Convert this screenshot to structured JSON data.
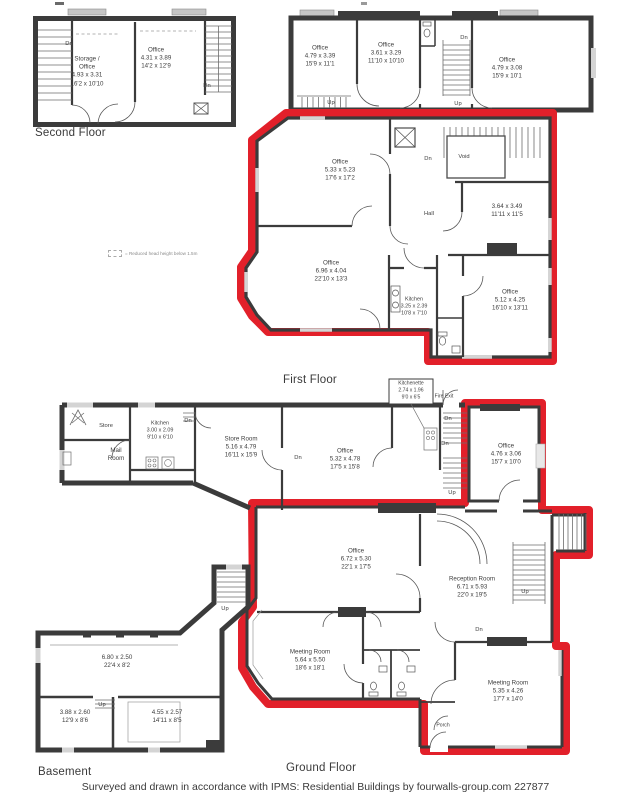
{
  "footer": "Surveyed and drawn in accordance with IPMS: Residential Buildings by fourwalls-group.com 227877",
  "legend": {
    "note": "= Reduced head height below 1.5m"
  },
  "floor_titles": {
    "second": "Second Floor",
    "first": "First Floor",
    "ground": "Ground Floor",
    "basement": "Basement"
  },
  "markers": {
    "dn": "Dn",
    "up": "Up",
    "fire_exit": "Fire Exit",
    "void": "Void",
    "hall": "Hall",
    "porch": "Porch",
    "store": "Store"
  },
  "colors": {
    "highlight_red": "#e2202a",
    "wall": "#3b3b3b"
  },
  "rooms": {
    "sf_storage_office": {
      "name1": "Storage /",
      "name2": "Office",
      "metric": "4.93 x 3.31",
      "imperial": "16'2 x 10'10"
    },
    "sf_office": {
      "name": "Office",
      "metric": "4.31 x 3.89",
      "imperial": "14'2 x 12'9"
    },
    "ff_office_a": {
      "name": "Office",
      "metric": "4.79 x 3.39",
      "imperial": "15'9 x 11'1"
    },
    "ff_office_b": {
      "name": "Office",
      "metric": "3.61 x 3.29",
      "imperial": "11'10 x 10'10"
    },
    "ff_office_c": {
      "name": "Office",
      "metric": "4.79 x 3.08",
      "imperial": "15'9 x 10'1"
    },
    "ff_office_d": {
      "name": "Office",
      "metric": "5.33 x 5.23",
      "imperial": "17'6 x 17'2"
    },
    "ff_room": {
      "metric": "3.64 x 3.49",
      "imperial": "11'11 x 11'5"
    },
    "ff_office_e": {
      "name": "Office",
      "metric": "6.96 x 4.04",
      "imperial": "22'10 x 13'3"
    },
    "ff_kitchen": {
      "name": "Kitchen",
      "metric": "3.25 x 2.39",
      "imperial": "10'8 x 7'10"
    },
    "ff_office_f": {
      "name": "Office",
      "metric": "5.12 x 4.25",
      "imperial": "16'10 x 13'11"
    },
    "gf_kitchen": {
      "name": "Kitchen",
      "metric": "3.00 x 2.09",
      "imperial": "9'10 x 6'10"
    },
    "gf_mail_room": {
      "name1": "Mail",
      "name2": "Room"
    },
    "gf_store_room": {
      "name": "Store Room",
      "metric": "5.16 x 4.79",
      "imperial": "16'11 x 15'9"
    },
    "gf_office_a": {
      "name": "Office",
      "metric": "5.32 x 4.78",
      "imperial": "17'5 x 15'8"
    },
    "gf_kitchenette": {
      "name": "Kitchenette",
      "metric": "2.74 x 1.96",
      "imperial": "9'0 x 6'5"
    },
    "gf_office_b": {
      "name": "Office",
      "metric": "4.76 x 3.06",
      "imperial": "15'7 x 10'0"
    },
    "gf_office_c": {
      "name": "Office",
      "metric": "6.72 x 5.30",
      "imperial": "22'1 x 17'5"
    },
    "gf_reception": {
      "name": "Reception Room",
      "metric": "6.71 x 5.93",
      "imperial": "22'0 x 19'5"
    },
    "gf_meeting_a": {
      "name": "Meeting Room",
      "metric": "5.64 x 5.50",
      "imperial": "18'6 x 18'1"
    },
    "gf_meeting_b": {
      "name": "Meeting Room",
      "metric": "5.35 x 4.26",
      "imperial": "17'7 x 14'0"
    },
    "bs_room_a": {
      "metric": "6.80 x 2.50",
      "imperial": "22'4 x 8'2"
    },
    "bs_room_b": {
      "metric": "3.88 x 2.60",
      "imperial": "12'9 x 8'6"
    },
    "bs_room_c": {
      "metric": "4.55 x 2.57",
      "imperial": "14'11 x 8'5"
    }
  }
}
